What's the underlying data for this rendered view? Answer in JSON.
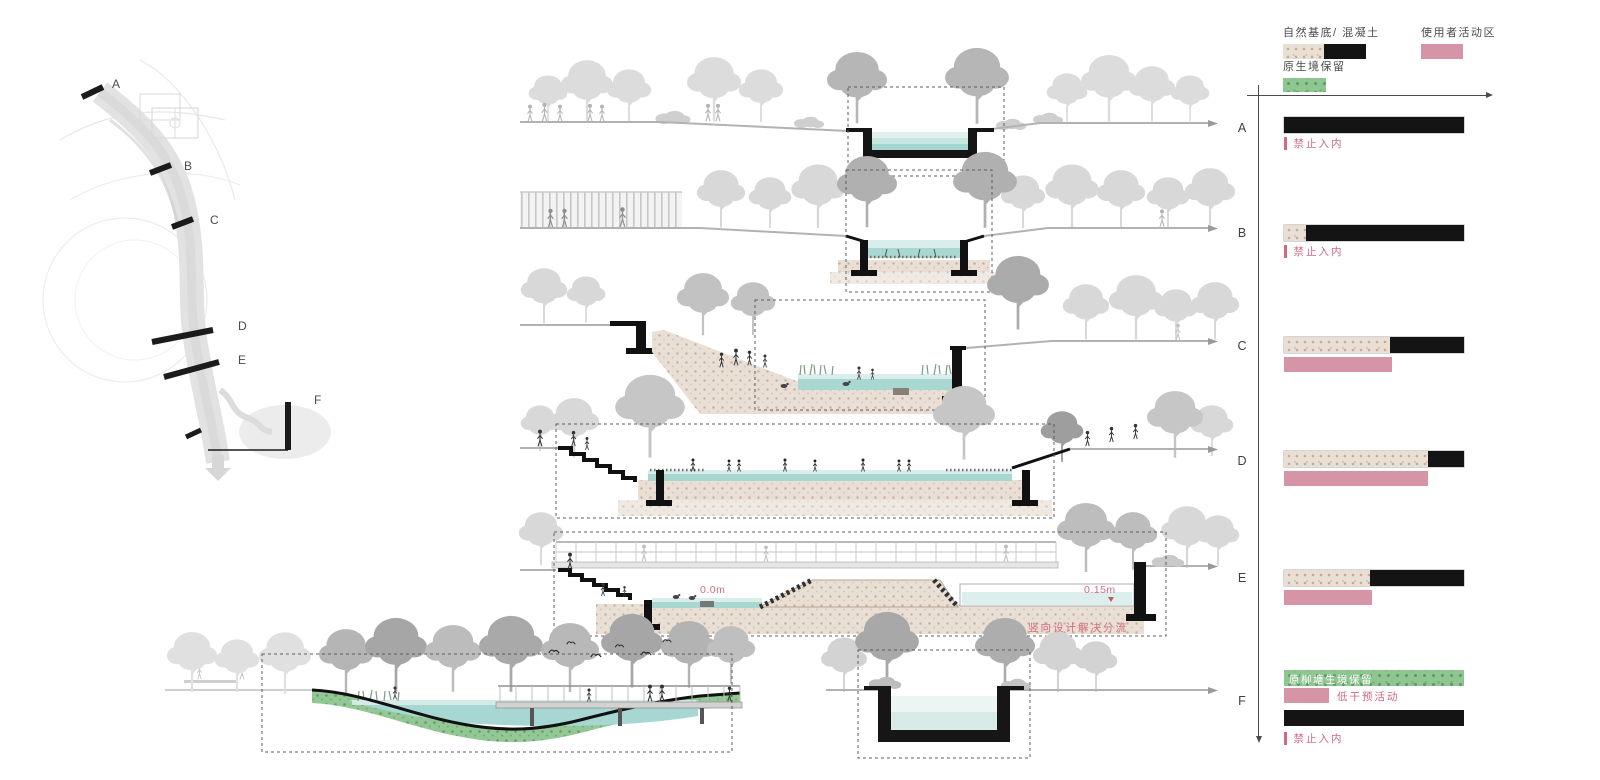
{
  "site_plan": {
    "section_labels": [
      "A",
      "B",
      "C",
      "D",
      "E",
      "F"
    ]
  },
  "sections": {
    "e": {
      "left_level": "0.0m",
      "right_level": "0.15m",
      "note": "竖向设计解决分流"
    }
  },
  "legend": {
    "items": [
      {
        "label": "自然基底/ 混凝土",
        "swatches": [
          "natural",
          "concrete"
        ]
      },
      {
        "label": "使用者活动区",
        "swatches": [
          "activity"
        ]
      },
      {
        "label": "原生境保留",
        "swatches": [
          "habitat"
        ]
      }
    ]
  },
  "colors": {
    "natural_base": "#e9dfd4",
    "natural_dot": "#c2ab9a",
    "concrete": "#141414",
    "activity_pink": "#d694a7",
    "habitat_green": "#8fc591",
    "habitat_dot": "#5b9c60",
    "water_teal": "#a9d8d3",
    "water_pale": "#e9f4f2",
    "annotation_pink": "#cf6a80",
    "ground_gray": "#b2b2b2",
    "tree_gray": "#d9d9d9"
  },
  "chart_data": {
    "type": "bar",
    "orientation": "horizontal",
    "title": "",
    "categories": [
      "A",
      "B",
      "C",
      "D",
      "E",
      "F"
    ],
    "unit": "percent of channel cross-section width",
    "legend_entries": [
      "自然基底/ 混凝土",
      "使用者活动区",
      "原生境保留"
    ],
    "layout": {
      "top_axis_arrow": "right",
      "left_axis_arrow": "down",
      "grid": false
    },
    "rows": [
      {
        "section": "A",
        "bars": [
          {
            "kind": "substrate",
            "segments": [
              {
                "material": "concrete",
                "pct": 100
              }
            ]
          }
        ],
        "note": "禁止入内"
      },
      {
        "section": "B",
        "bars": [
          {
            "kind": "substrate",
            "segments": [
              {
                "material": "natural",
                "pct": 12
              },
              {
                "material": "concrete",
                "pct": 88
              }
            ]
          }
        ],
        "note": "禁止入内"
      },
      {
        "section": "C",
        "bars": [
          {
            "kind": "substrate",
            "segments": [
              {
                "material": "natural",
                "pct": 59
              },
              {
                "material": "concrete",
                "pct": 41
              }
            ]
          },
          {
            "kind": "activity",
            "segments": [
              {
                "material": "activity",
                "pct": 60
              }
            ]
          }
        ]
      },
      {
        "section": "D",
        "bars": [
          {
            "kind": "substrate",
            "segments": [
              {
                "material": "natural",
                "pct": 80
              },
              {
                "material": "concrete",
                "pct": 20
              }
            ]
          },
          {
            "kind": "activity",
            "segments": [
              {
                "material": "activity",
                "pct": 80
              }
            ]
          }
        ]
      },
      {
        "section": "E",
        "bars": [
          {
            "kind": "substrate",
            "segments": [
              {
                "material": "natural",
                "pct": 48
              },
              {
                "material": "concrete",
                "pct": 52
              }
            ]
          },
          {
            "kind": "activity",
            "segments": [
              {
                "material": "activity",
                "pct": 49
              }
            ]
          }
        ]
      },
      {
        "section": "F",
        "bars": [
          {
            "kind": "habitat",
            "segments": [
              {
                "material": "habitat",
                "pct": 100
              }
            ],
            "inline_label": "原柳塘生境保留"
          },
          {
            "kind": "activity",
            "segments": [
              {
                "material": "activity",
                "pct": 25
              }
            ],
            "side_label": "低干预活动"
          },
          {
            "kind": "substrate",
            "segments": [
              {
                "material": "concrete",
                "pct": 100
              }
            ]
          }
        ],
        "note": "禁止入内"
      }
    ]
  }
}
